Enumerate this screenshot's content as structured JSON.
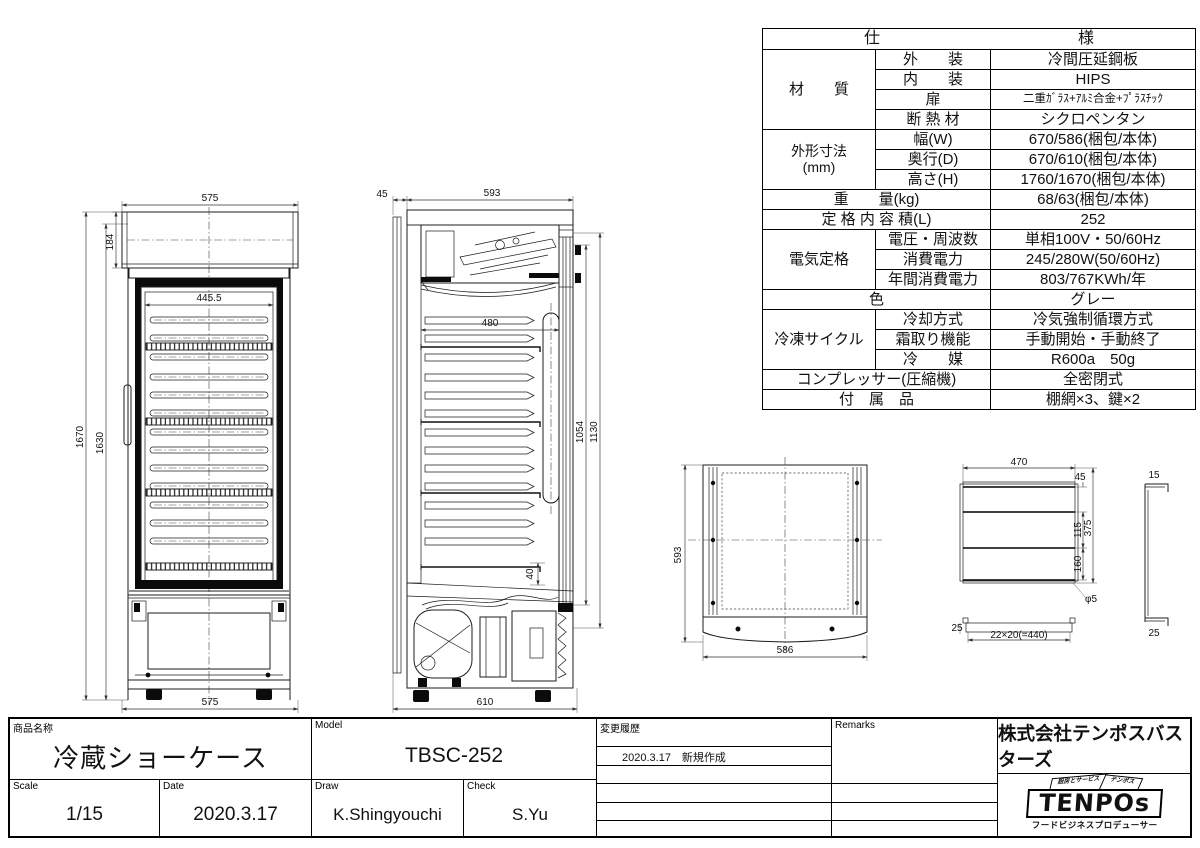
{
  "spec": {
    "header": {
      "left": "仕",
      "right": "様"
    },
    "material": {
      "label": "材　　質",
      "rows": [
        {
          "k": "外　　装",
          "v": "冷間圧延鋼板"
        },
        {
          "k": "内　　装",
          "v": "HIPS"
        },
        {
          "k": "扉",
          "v": "二重ｶﾞﾗｽ+ｱﾙﾐ合金+ﾌﾟﾗｽﾁｯｸ"
        },
        {
          "k": "断 熱 材",
          "v": "シクロペンタン"
        }
      ]
    },
    "dims": {
      "label": "外形寸法",
      "label2": "(mm)",
      "rows": [
        {
          "k": "幅(W)",
          "v": "670/586(梱包/本体)"
        },
        {
          "k": "奥行(D)",
          "v": "670/610(梱包/本体)"
        },
        {
          "k": "高さ(H)",
          "v": "1760/1670(梱包/本体)"
        }
      ]
    },
    "weight": {
      "k": "重　　量(kg)",
      "v": "68/63(梱包/本体)"
    },
    "capacity": {
      "k": "定 格 内 容 積(L)",
      "v": "252"
    },
    "elec": {
      "label": "電気定格",
      "rows": [
        {
          "k": "電圧・周波数",
          "v": "単相100V・50/60Hz"
        },
        {
          "k": "消費電力",
          "v": "245/280W(50/60Hz)"
        },
        {
          "k": "年間消費電力",
          "v": "803/767KWh/年"
        }
      ]
    },
    "color": {
      "k": "色",
      "v": "グレー"
    },
    "refr": {
      "label": "冷凍サイクル",
      "rows": [
        {
          "k": "冷却方式",
          "v": "冷気強制循環方式"
        },
        {
          "k": "霜取り機能",
          "v": "手動開始・手動終了"
        },
        {
          "k": "冷　　媒",
          "v": "R600a　50g"
        }
      ]
    },
    "comp": {
      "k": "コンプレッサー(圧縮機)",
      "v": "全密閉式"
    },
    "acc": {
      "k": "付　属　品",
      "v": "棚網×3、鍵×2"
    }
  },
  "tb": {
    "product_label": "商品名称",
    "product_name": "冷蔵ショーケース",
    "model_label": "Model",
    "model_value": "TBSC-252",
    "scale_label": "Scale",
    "scale_value": "1/15",
    "date_label": "Date",
    "date_value": "2020.3.17",
    "draw_label": "Draw",
    "draw_value": "K.Shingyouchi",
    "check_label": "Check",
    "check_value": "S.Yu",
    "history_label": "変更履歴",
    "history_entry": "2020.3.17　新規作成",
    "remarks_label": "Remarks",
    "company": "株式会社テンポスバスターズ",
    "logo": {
      "main": "TENPOs",
      "ribbon_left": "厨房とサービス",
      "ribbon_right": "テンポス",
      "tagline": "フードビジネスプロデューサー"
    }
  },
  "v": {
    "front": {
      "w_top": "575",
      "h_canopy": "184",
      "w_inner": "445.5",
      "h_overall": "1670",
      "h_body": "1630",
      "w_bottom": "575"
    },
    "side": {
      "rear": "45",
      "depth": "593",
      "inner": "480",
      "door_h": "1054",
      "front_h": "1130",
      "gap": "40",
      "base": "610"
    },
    "top": {
      "depth": "593",
      "width": "586"
    },
    "shelf": {
      "w": "470",
      "d": "375",
      "s1": "45",
      "s2": "115",
      "s3": "160",
      "pitch": "22×20(=440)",
      "e1": "25",
      "e2": "15",
      "e3": "25",
      "note": "φ5"
    }
  }
}
